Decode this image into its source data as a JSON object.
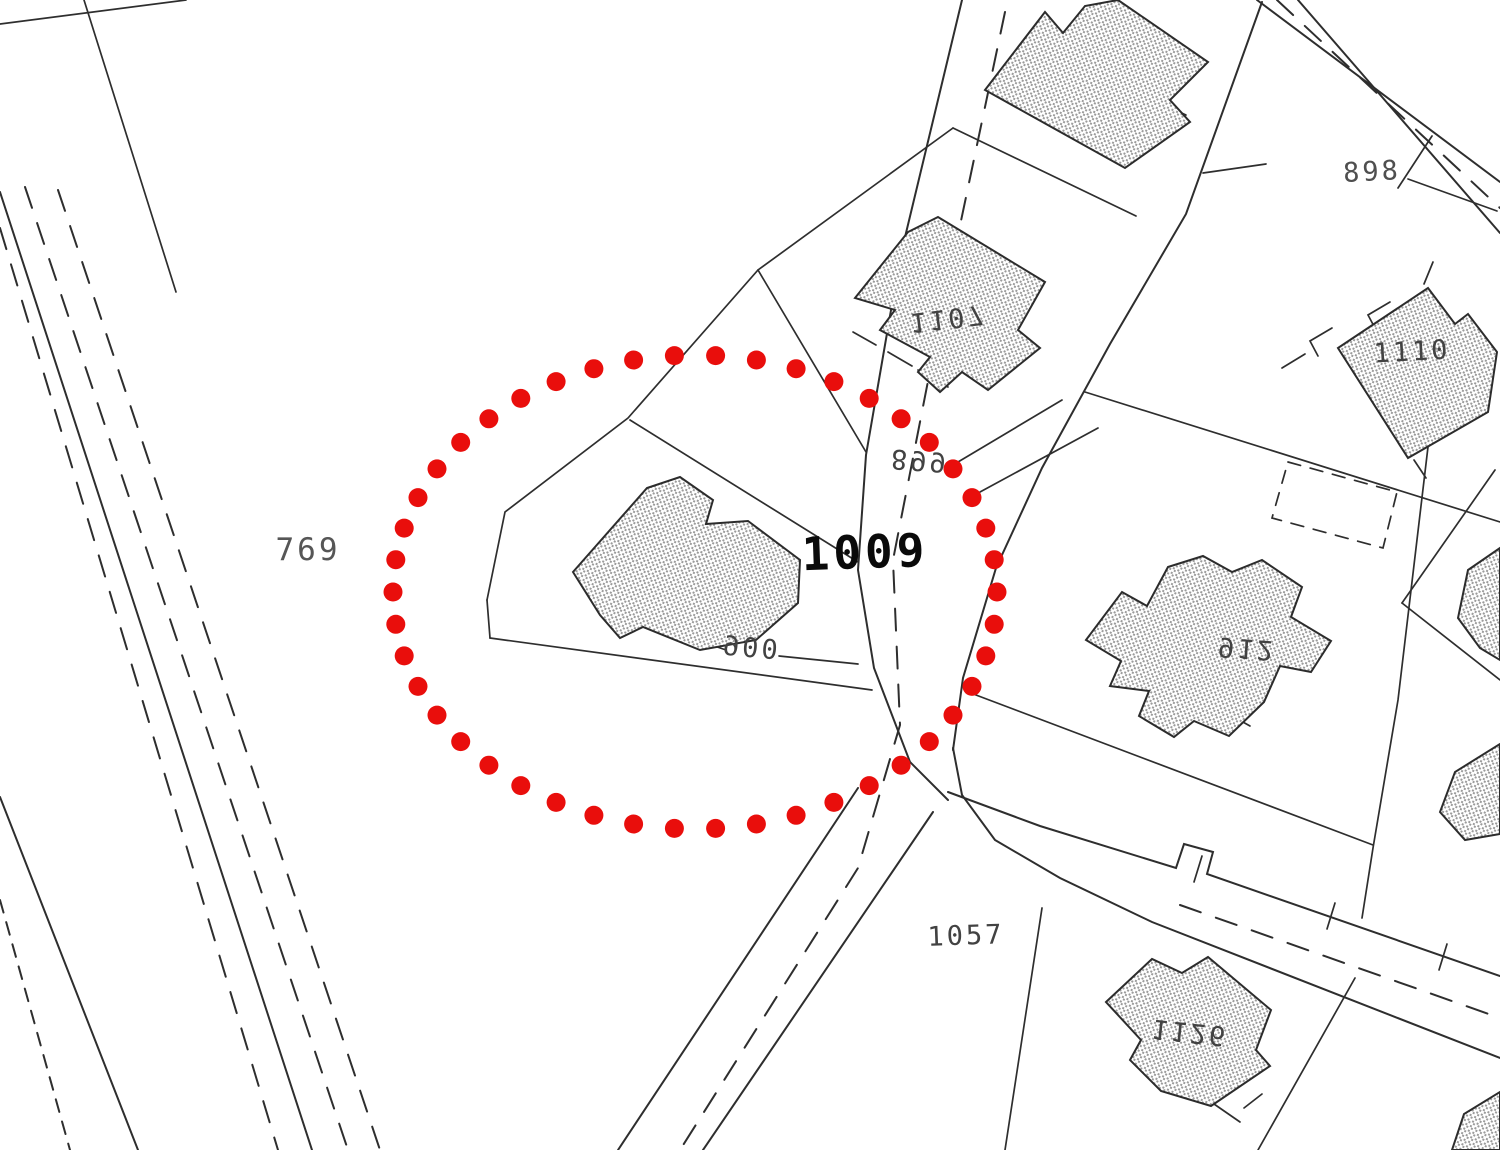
{
  "canvas": {
    "background": "#ffffff",
    "line_color": "#2e2e2e",
    "hatch_color": "#989898"
  },
  "labels": {
    "p769": "769",
    "p898": "898",
    "p899": "899",
    "p900": "900",
    "p912": "912",
    "p1009": "1009",
    "p1057": "1057",
    "p1107": "1107",
    "p1110": "1110",
    "p1126": "1126"
  },
  "highlight": {
    "shape": "dotted-ellipse",
    "color": "#e90e0c",
    "center_x": 695,
    "center_y": 592,
    "radius_x": 302,
    "radius_y": 237,
    "dot_radius": 9.5,
    "dot_count": 46
  }
}
